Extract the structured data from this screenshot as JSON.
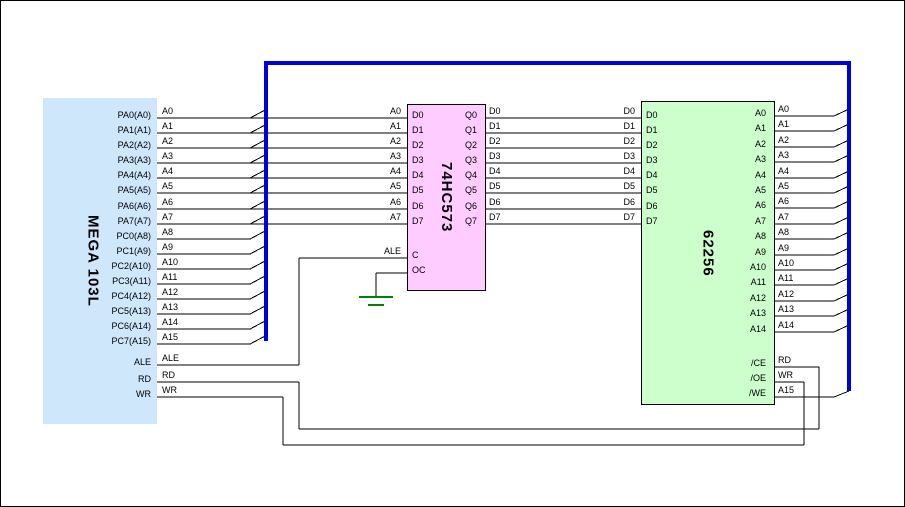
{
  "colors": {
    "background": "#ffffff",
    "border": "#000000",
    "wire": "#000000",
    "address_bus": "#0000dd",
    "ground": "#008000",
    "mcu_fill": "#cfe7fa",
    "latch_fill": "#ffccff",
    "sram_fill": "#ccffcc"
  },
  "mcu": {
    "name": "MEGA 103L",
    "pins": [
      "PA0(A0)",
      "PA1(A1)",
      "PA2(A2)",
      "PA3(A3)",
      "PA4(A4)",
      "PA5(A5)",
      "PA6(A6)",
      "PA7(A7)",
      "PC0(A8)",
      "PC1(A9)",
      "PC2(A10)",
      "PC3(A11)",
      "PC4(A12)",
      "PC5(A13)",
      "PC6(A14)",
      "PC7(A15)",
      "ALE",
      "RD",
      "WR"
    ]
  },
  "latch": {
    "name": "74HC573",
    "input_pins": [
      "D0",
      "D1",
      "D2",
      "D3",
      "D4",
      "D5",
      "D6",
      "D7"
    ],
    "output_pins": [
      "Q0",
      "Q1",
      "Q2",
      "Q3",
      "Q4",
      "Q5",
      "Q6",
      "Q7"
    ],
    "latch_enable_pin": "C",
    "output_enable_pin": "OC"
  },
  "sram": {
    "name": "62256",
    "data_pins": [
      "D0",
      "D1",
      "D2",
      "D3",
      "D4",
      "D5",
      "D6",
      "D7"
    ],
    "address_pins": [
      "A0",
      "A1",
      "A2",
      "A3",
      "A4",
      "A5",
      "A6",
      "A7",
      "A8",
      "A9",
      "A10",
      "A11",
      "A12",
      "A13",
      "A14"
    ],
    "control_pins": [
      "/CE",
      "/OE",
      "/WE"
    ]
  },
  "wire_labels": {
    "mcu_outputs": [
      "A0",
      "A1",
      "A2",
      "A3",
      "A4",
      "A5",
      "A6",
      "A7",
      "A8",
      "A9",
      "A10",
      "A11",
      "A12",
      "A13",
      "A14",
      "A15",
      "ALE",
      "RD",
      "WR"
    ],
    "latch_inputs": [
      "A0",
      "A1",
      "A2",
      "A3",
      "A4",
      "A5",
      "A6",
      "A7"
    ],
    "latch_clock_input": "ALE",
    "data_bus_at_latch": [
      "D0",
      "D1",
      "D2",
      "D3",
      "D4",
      "D5",
      "D6",
      "D7"
    ],
    "data_bus_at_sram": [
      "D0",
      "D1",
      "D2",
      "D3",
      "D4",
      "D5",
      "D6",
      "D7"
    ],
    "sram_address_inputs": [
      "A0",
      "A1",
      "A2",
      "A3",
      "A4",
      "A5",
      "A6",
      "A7",
      "A8",
      "A9",
      "A10",
      "A11",
      "A12",
      "A13",
      "A14"
    ],
    "sram_control_inputs": [
      "RD",
      "WR",
      "A15"
    ]
  }
}
